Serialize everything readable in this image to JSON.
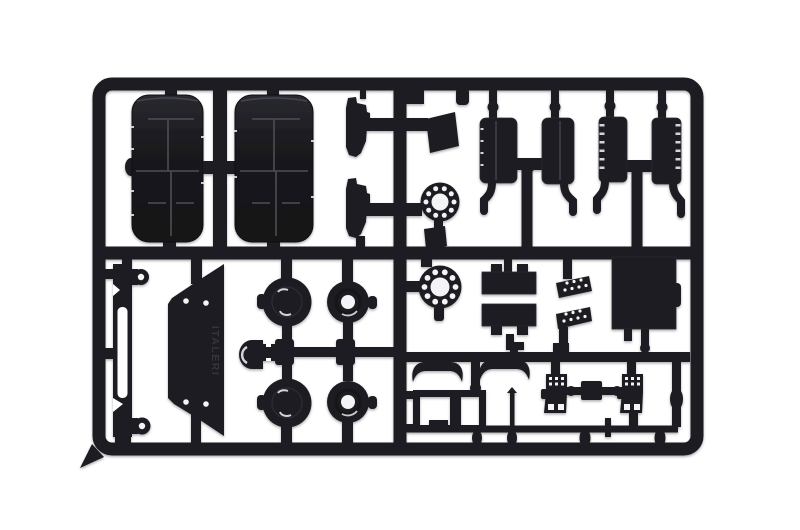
{
  "meta": {
    "subject": "Photograph of a black injection-molded plastic model-kit sprue (parts tree) on a white background",
    "embossed_text": "ITALERI",
    "colors": {
      "background": "#ffffff",
      "plastic": "#1d1d21",
      "plastic_dark": "#141417",
      "plastic_highlight": "#4a4a52",
      "detail_light": "#f4f4f6"
    }
  },
  "parts": [
    {
      "name": "tire-half",
      "label": "Truck tire half with tread grooves",
      "quantity": 2
    },
    {
      "name": "wheel-hub-solid",
      "label": "Wheel hub, solid face with lug detail",
      "quantity": 2
    },
    {
      "name": "wheel-hub-bored",
      "label": "Wheel hub with center bore",
      "quantity": 2
    },
    {
      "name": "bolt-circle-flange",
      "label": "Drilled bolt-circle flange ring",
      "quantity": 2
    },
    {
      "name": "tank",
      "label": "Fuel / air tank with mounting leg",
      "quantity": 4
    },
    {
      "name": "battery-box",
      "label": "Battery box with locating lugs",
      "quantity": 2
    },
    {
      "name": "step-plate",
      "label": "Perforated step plate",
      "quantity": 2
    },
    {
      "name": "equipment-box",
      "label": "Large equipment box panel",
      "quantity": 1
    },
    {
      "name": "cab-panel",
      "label": "Angled panel with four locating holes",
      "quantity": 1
    },
    {
      "name": "chassis-rail",
      "label": "Slotted chassis side rail with eyelets",
      "quantity": 1
    },
    {
      "name": "mudflap-bracket",
      "label": "Mudflap bracket",
      "quantity": 2
    },
    {
      "name": "mudflap",
      "label": "Mudflap plate",
      "quantity": 2
    },
    {
      "name": "curved-bar",
      "label": "Bar part with curved ends",
      "quantity": 2
    },
    {
      "name": "ladder-frame",
      "label": "Ladder frame",
      "quantity": 1
    },
    {
      "name": "thin-rod",
      "label": "Thin rod",
      "quantity": 1
    },
    {
      "name": "step-box",
      "label": "Treaded step box",
      "quantity": 2
    },
    {
      "name": "axle-spacer",
      "label": "Axle with center spacer",
      "quantity": 1
    },
    {
      "name": "hub-cap",
      "label": "Drum-shaped hub cap",
      "quantity": 1
    }
  ]
}
